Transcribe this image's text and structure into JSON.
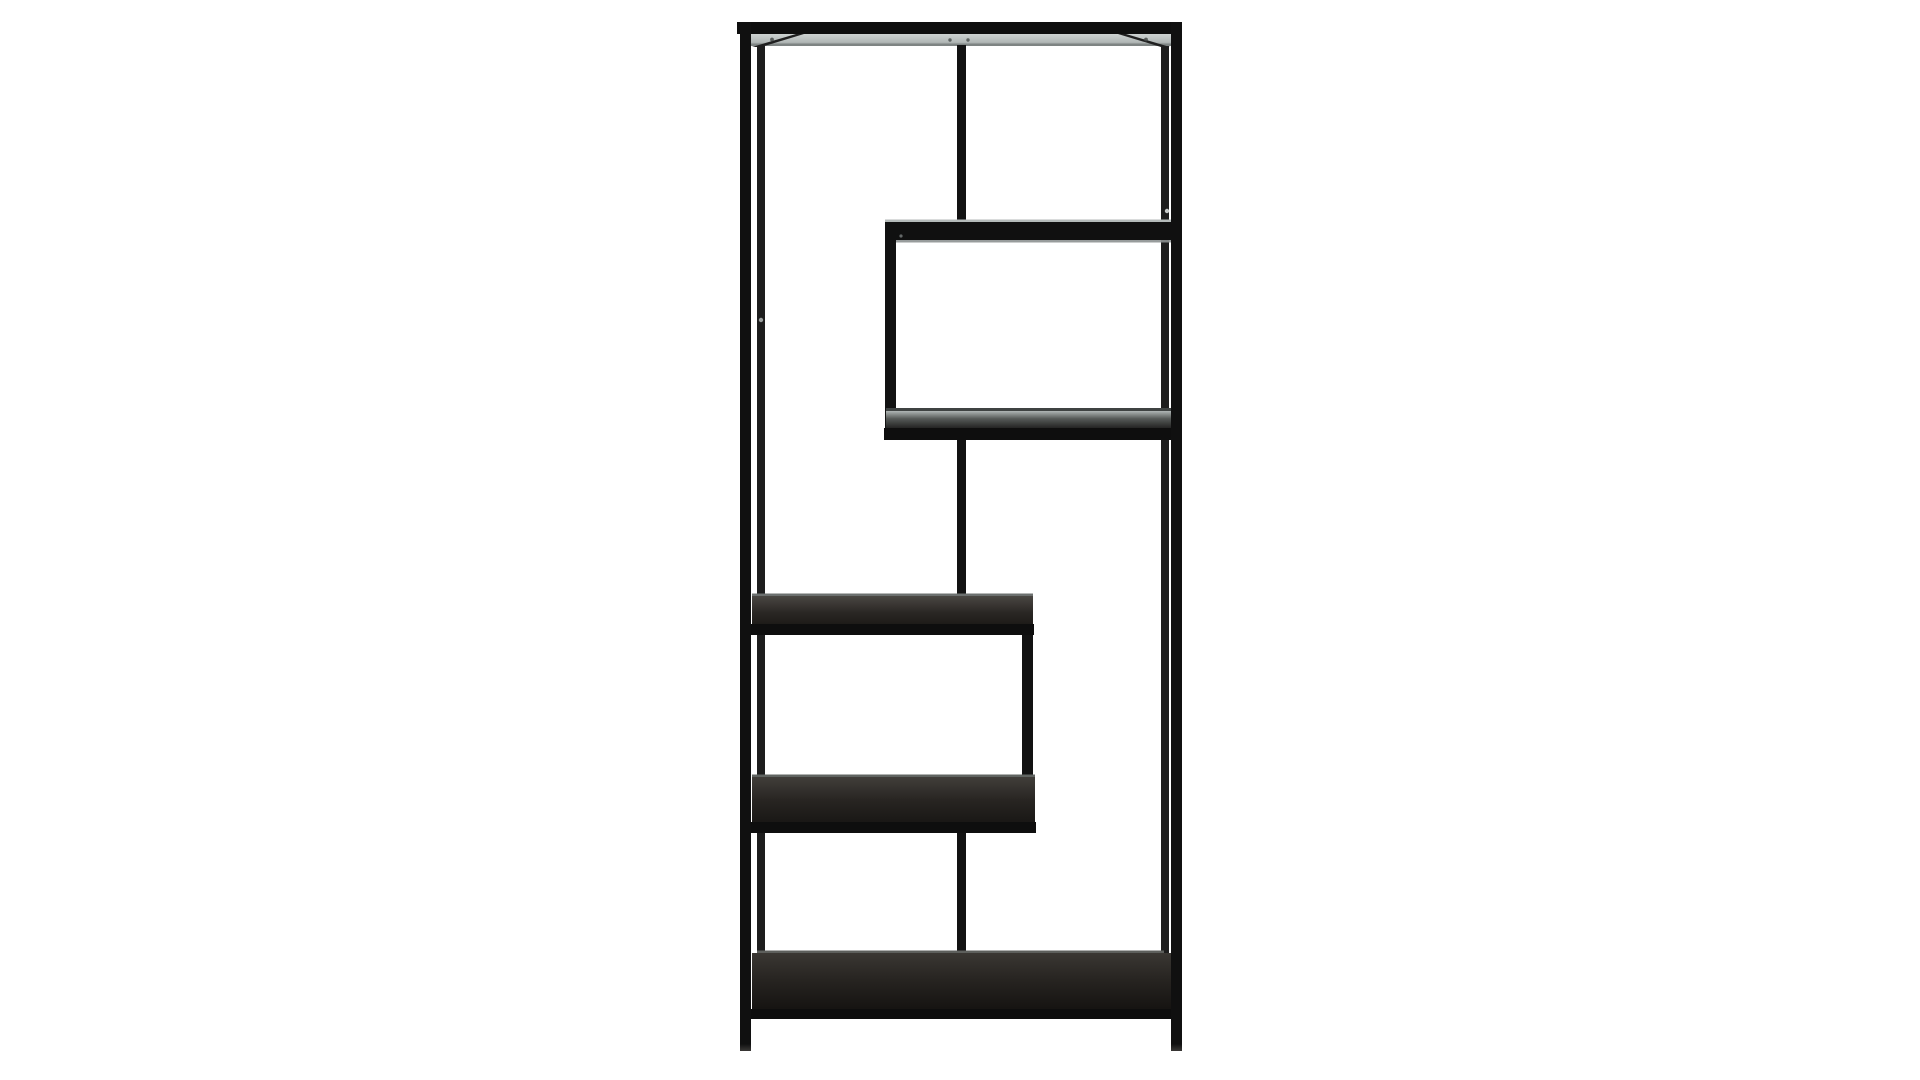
{
  "product": {
    "name": "Black metal asymmetric open bookcase with staggered shelves",
    "frame_material": "black metal",
    "shelf_material": "black ash wood veneer",
    "shelf_count": 6,
    "orientation": "front view, studio shot on white background"
  },
  "scene": {
    "background": "#ffffff",
    "view": {
      "width": 1920,
      "height": 1080
    },
    "palette": {
      "frame_black": "#101010",
      "frame_soft_black": "#1d1d1d",
      "top_sheen_light": "#c9cecd",
      "top_sheen_dark": "#a2a8a7",
      "wood_dark": "#1d1b18",
      "edge_gray": "#7e8483",
      "background_white": "#ffffff"
    },
    "gradients": [
      {
        "id": "gTopStrip",
        "stops": [
          [
            "0%",
            "#cdd2d1"
          ],
          [
            "70%",
            "#b3b9b8"
          ],
          [
            "100%",
            "#9aa09f"
          ]
        ]
      },
      {
        "id": "gShelf3",
        "stops": [
          [
            "0%",
            "#b0b6b5"
          ],
          [
            "45%",
            "#565a58"
          ],
          [
            "100%",
            "#242423"
          ]
        ]
      },
      {
        "id": "gShelf4",
        "stops": [
          [
            "0%",
            "#4a4743"
          ],
          [
            "55%",
            "#2b2825"
          ],
          [
            "100%",
            "#1d1b18"
          ]
        ]
      },
      {
        "id": "gShelf5",
        "stops": [
          [
            "0%",
            "#413e3a"
          ],
          [
            "50%",
            "#282522"
          ],
          [
            "100%",
            "#191715"
          ]
        ]
      },
      {
        "id": "gShelfBottom",
        "stops": [
          [
            "0%",
            "#3a3733"
          ],
          [
            "50%",
            "#262320"
          ],
          [
            "100%",
            "#151311"
          ]
        ]
      },
      {
        "id": "gLegFade",
        "stops": [
          [
            "0%",
            "#101010"
          ],
          [
            "100%",
            "#3a3836"
          ]
        ]
      }
    ],
    "parts": [
      {
        "name": "backdrop",
        "shape": "rect",
        "x": 0,
        "y": 0,
        "w": 1920,
        "h": 1080,
        "fill": "#ffffff"
      },
      {
        "name": "back-post-left",
        "shape": "rect",
        "x": 757,
        "y": 44,
        "w": 8,
        "h": 909,
        "fill": "#1d1d1d"
      },
      {
        "name": "back-post-right",
        "shape": "rect",
        "x": 1161,
        "y": 44,
        "w": 8,
        "h": 909,
        "fill": "#1d1d1d"
      },
      {
        "name": "top-shelf-underside",
        "shape": "rect",
        "x": 751,
        "y": 34,
        "w": 420,
        "h": 11,
        "fill": "url(#gTopStrip)"
      },
      {
        "name": "top-shelf-back-edge",
        "shape": "rect",
        "x": 751,
        "y": 43.5,
        "w": 420,
        "h": 2.5,
        "fill": "#7e8483"
      },
      {
        "name": "top-corner-rail-left",
        "shape": "polygon",
        "points": "752,47 796,34 804,34 761,47",
        "fill": "#1f1f1f"
      },
      {
        "name": "top-corner-rail-right",
        "shape": "polygon",
        "points": "1170,47 1126,34 1118,34 1161,47",
        "fill": "#1f1f1f"
      },
      {
        "name": "top-strip-screw-1",
        "shape": "circle",
        "cx": 772,
        "cy": 39.5,
        "r": 1.9,
        "fill": "#454a49",
        "opacity": 0.85
      },
      {
        "name": "top-strip-screw-2",
        "shape": "circle",
        "cx": 950,
        "cy": 40,
        "r": 1.7,
        "fill": "#454a49",
        "opacity": 0.8
      },
      {
        "name": "top-strip-screw-3",
        "shape": "circle",
        "cx": 968,
        "cy": 40,
        "r": 1.7,
        "fill": "#454a49",
        "opacity": 0.8
      },
      {
        "name": "top-strip-screw-4",
        "shape": "circle",
        "cx": 1146,
        "cy": 39.5,
        "r": 1.9,
        "fill": "#454a49",
        "opacity": 0.85
      },
      {
        "name": "top-frame-bar",
        "shape": "rect",
        "x": 737,
        "y": 22,
        "w": 445,
        "h": 12,
        "fill": "#0e0e0e"
      },
      {
        "name": "divider-top-center",
        "shape": "rect",
        "x": 957,
        "y": 45,
        "w": 9,
        "h": 179,
        "fill": "#121212"
      },
      {
        "name": "shelf-2-top-edge",
        "shape": "rect",
        "x": 885,
        "y": 219.5,
        "w": 288,
        "h": 2.5,
        "fill": "#b4bab9"
      },
      {
        "name": "shelf-2-frame-bar",
        "shape": "rect",
        "x": 885,
        "y": 222,
        "w": 288,
        "h": 18,
        "fill": "#101010"
      },
      {
        "name": "shelf-2-bottom-edge",
        "shape": "rect",
        "x": 885,
        "y": 240,
        "w": 288,
        "h": 2.5,
        "fill": "#8d9191",
        "opacity": 0.9
      },
      {
        "name": "shelf-2-corner-screw",
        "shape": "circle",
        "cx": 901,
        "cy": 236,
        "r": 1.6,
        "fill": "#6e7272",
        "opacity": 0.9
      },
      {
        "name": "upper-cube-left-post",
        "shape": "rect",
        "x": 885,
        "y": 240,
        "w": 11,
        "h": 190,
        "fill": "#121212"
      },
      {
        "name": "shelf-3-back-edge",
        "shape": "rect",
        "x": 886,
        "y": 408,
        "w": 286,
        "h": 3,
        "fill": "#3f4342"
      },
      {
        "name": "shelf-3-wood-top",
        "shape": "rect",
        "x": 886,
        "y": 411,
        "w": 286,
        "h": 17,
        "fill": "url(#gShelf3)"
      },
      {
        "name": "shelf-3-front-bar",
        "shape": "rect",
        "x": 884,
        "y": 428,
        "w": 289,
        "h": 12,
        "fill": "#0e0e0e"
      },
      {
        "name": "divider-middle-center",
        "shape": "rect",
        "x": 957,
        "y": 440,
        "w": 9,
        "h": 154,
        "fill": "#121212"
      },
      {
        "name": "divider-middle-over-shelf",
        "shape": "rect",
        "x": 958.5,
        "y": 594,
        "w": 6,
        "h": 31,
        "fill": "#141414",
        "opacity": 0.85
      },
      {
        "name": "shelf-4-back-edge",
        "shape": "rect",
        "x": 752,
        "y": 593.5,
        "w": 281,
        "h": 2.5,
        "fill": "#6c706f"
      },
      {
        "name": "shelf-4-wood-top",
        "shape": "rect",
        "x": 752,
        "y": 596,
        "w": 281,
        "h": 29,
        "fill": "url(#gShelf4)"
      },
      {
        "name": "shelf-4-front-bar",
        "shape": "rect",
        "x": 750,
        "y": 624,
        "w": 284,
        "h": 11,
        "fill": "#0e0e0e"
      },
      {
        "name": "lower-cube-right-post",
        "shape": "rect",
        "x": 1022,
        "y": 635,
        "w": 11,
        "h": 142,
        "fill": "#121212"
      },
      {
        "name": "lower-cube-right-post-over-shelf",
        "shape": "rect",
        "x": 1024,
        "y": 777,
        "w": 7,
        "h": 46,
        "fill": "#141414",
        "opacity": 0.85
      },
      {
        "name": "shelf-5-back-edge",
        "shape": "rect",
        "x": 752,
        "y": 774.5,
        "w": 283,
        "h": 2.5,
        "fill": "#606461"
      },
      {
        "name": "shelf-5-wood-top",
        "shape": "rect",
        "x": 752,
        "y": 777,
        "w": 283,
        "h": 46,
        "fill": "url(#gShelf5)"
      },
      {
        "name": "shelf-5-front-bar",
        "shape": "rect",
        "x": 750,
        "y": 822,
        "w": 286,
        "h": 11,
        "fill": "#0e0e0e"
      },
      {
        "name": "divider-bottom-center",
        "shape": "rect",
        "x": 957,
        "y": 833,
        "w": 9,
        "h": 120,
        "fill": "#121212"
      },
      {
        "name": "divider-bottom-over-shelf",
        "shape": "rect",
        "x": 958.5,
        "y": 953,
        "w": 6,
        "h": 58,
        "fill": "#141414",
        "opacity": 0.85
      },
      {
        "name": "bottom-shelf-back-edge",
        "shape": "rect",
        "x": 757,
        "y": 950.5,
        "w": 407,
        "h": 2.5,
        "fill": "#5d5f5c"
      },
      {
        "name": "bottom-shelf-wood-top",
        "shape": "rect",
        "x": 752,
        "y": 953,
        "w": 419,
        "h": 57,
        "fill": "url(#gShelfBottom)"
      },
      {
        "name": "bottom-shelf-front-bar",
        "shape": "rect",
        "x": 742,
        "y": 1009,
        "w": 440,
        "h": 10,
        "fill": "#0d0d0d"
      },
      {
        "name": "front-post-left",
        "shape": "rect",
        "x": 740,
        "y": 22,
        "w": 11,
        "h": 1029,
        "fill": "#101010"
      },
      {
        "name": "front-post-right",
        "shape": "rect",
        "x": 1171,
        "y": 22,
        "w": 11,
        "h": 1029,
        "fill": "#101010"
      },
      {
        "name": "leg-tip-left",
        "shape": "rect",
        "x": 740,
        "y": 1044,
        "w": 11,
        "h": 7,
        "fill": "url(#gLegFade)"
      },
      {
        "name": "leg-tip-right",
        "shape": "rect",
        "x": 1171,
        "y": 1044,
        "w": 11,
        "h": 7,
        "fill": "url(#gLegFade)"
      },
      {
        "name": "shelf-pin-hole-left",
        "shape": "circle",
        "cx": 761,
        "cy": 320,
        "r": 2.2,
        "fill": "#9b9f9e"
      },
      {
        "name": "shelf-pin-hole-right",
        "shape": "circle",
        "cx": 1167,
        "cy": 211,
        "r": 2.2,
        "fill": "#c6cac9"
      }
    ]
  }
}
